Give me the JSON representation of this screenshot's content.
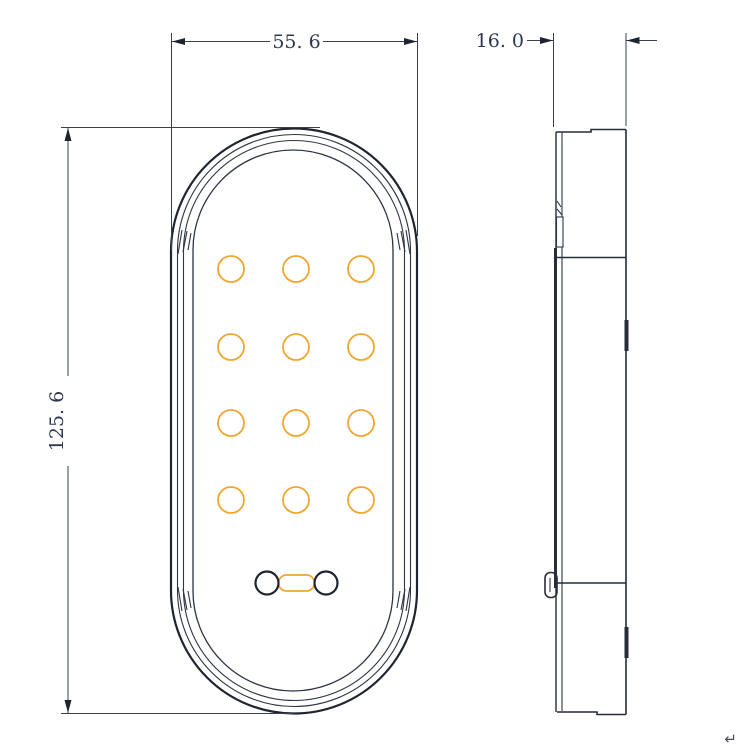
{
  "dimensions": {
    "width": "55. 6",
    "depth": "16. 0",
    "height": "125. 6"
  },
  "led_grid": {
    "rows": 4,
    "cols": 3,
    "count": 12
  },
  "connector": {
    "holes": 2,
    "bridge": 1
  },
  "colors": {
    "outline": "#262c3a",
    "led_accent": "#f0a732",
    "dimension_text": "#2c3750",
    "background": "#ffffff"
  },
  "corner_mark": "↵"
}
